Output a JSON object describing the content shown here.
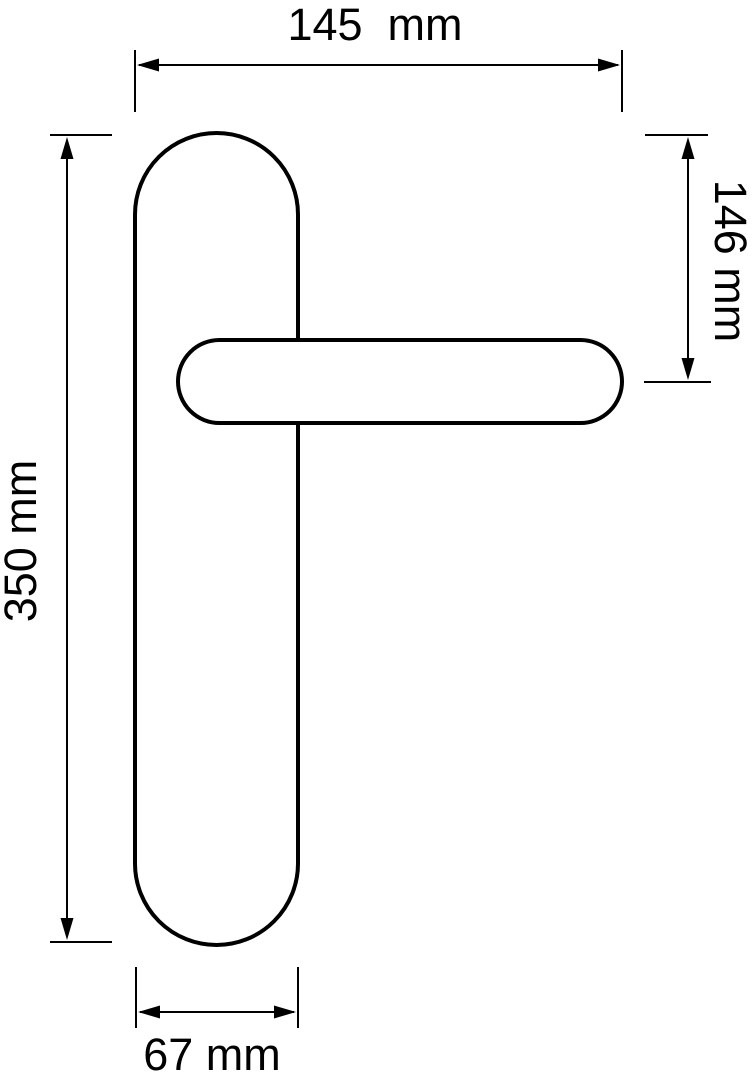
{
  "diagram": {
    "subject": "lever door handle on rounded backplate, front elevation",
    "colors": {
      "line": "#000000",
      "background": "#ffffff"
    }
  },
  "dimensions": {
    "total_width": {
      "label": "145  mm",
      "value": 145,
      "unit": "mm"
    },
    "handle_axis_from_top": {
      "label": "146 mm",
      "value": 146,
      "unit": "mm"
    },
    "total_height": {
      "label": "350 mm",
      "value": 350,
      "unit": "mm"
    },
    "backplate_width": {
      "label": "67 mm",
      "value": 67,
      "unit": "mm"
    }
  }
}
